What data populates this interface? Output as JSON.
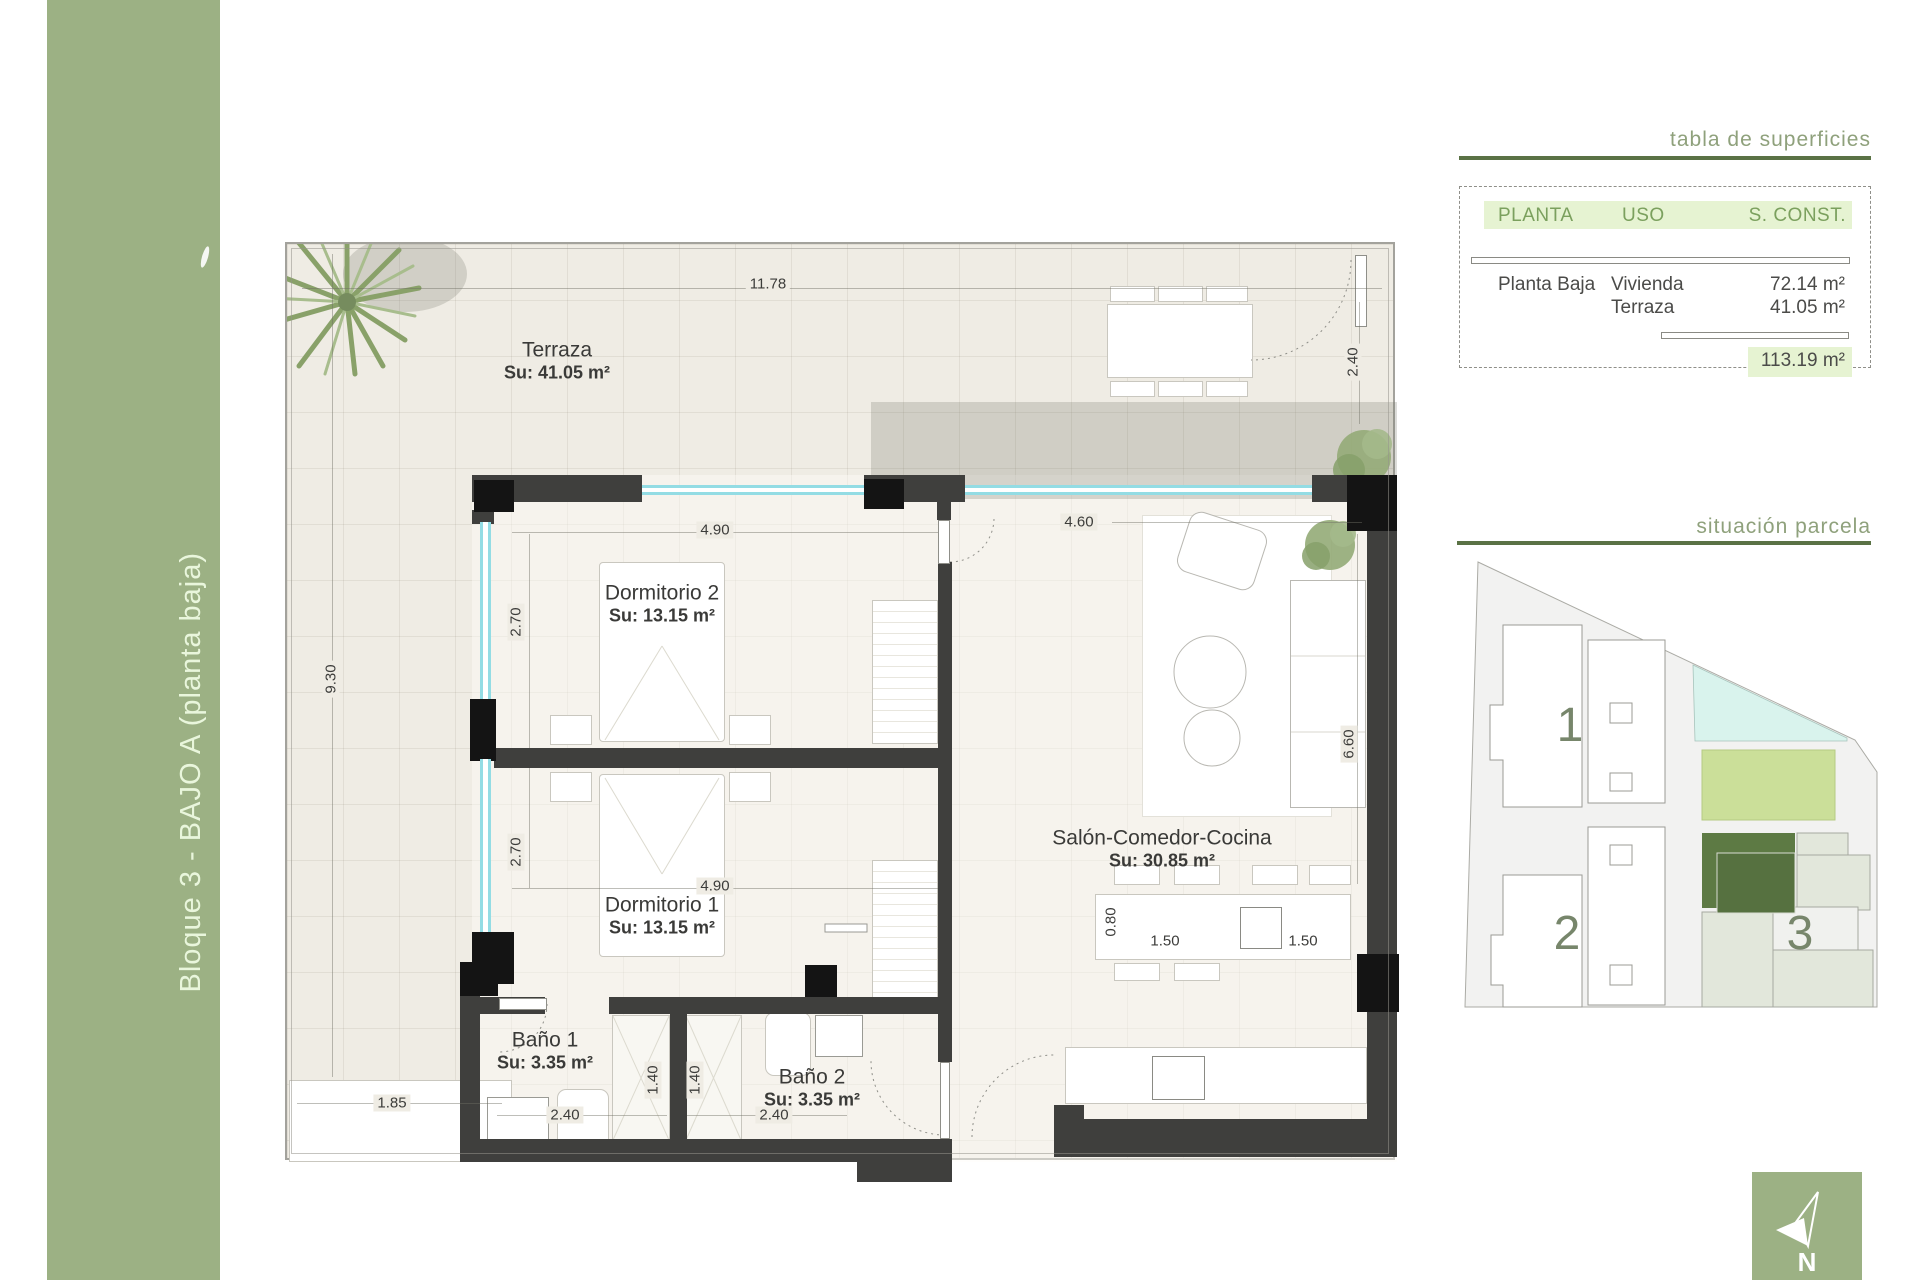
{
  "sidebar": {
    "label": "Bloque 3 - BAJO A (planta baja)"
  },
  "surfaces": {
    "title": "tabla de superficies",
    "headers": [
      "PLANTA",
      "USO",
      "S. CONST."
    ],
    "rows": [
      {
        "planta": "Planta Baja",
        "uso": "Vivienda",
        "sconst": "72.14 m²"
      },
      {
        "planta": "",
        "uso": "Terraza",
        "sconst": "41.05 m²"
      }
    ],
    "total": "113.19 m²"
  },
  "site": {
    "title": "situación parcela",
    "block1": "1",
    "block2": "2",
    "block3": "3"
  },
  "north": {
    "label": "N"
  },
  "plan": {
    "rooms": {
      "terraza": {
        "name": "Terraza",
        "area": "Su: 41.05 m²"
      },
      "dormitorio2": {
        "name": "Dormitorio 2",
        "area": "Su: 13.15 m²"
      },
      "dormitorio1": {
        "name": "Dormitorio 1",
        "area": "Su: 13.15 m²"
      },
      "salon": {
        "name": "Salón-Comedor-Cocina",
        "area": "Su: 30.85 m²"
      },
      "bano1": {
        "name": "Baño 1",
        "area": "Su: 3.35 m²"
      },
      "bano2": {
        "name": "Baño 2",
        "area": "Su: 3.35 m²"
      }
    },
    "dims": {
      "total_width": "11.78",
      "terrace_left_height": "9.30",
      "terrace_right_depth": "2.40",
      "dorm2_width": "4.90",
      "dorm2_height": "2.70",
      "dorm1_width": "4.90",
      "dorm1_height": "2.70",
      "salon_width": "4.60",
      "salon_height": "6.60",
      "planter_width": "1.85",
      "bano1_shower": "1.40",
      "bano2_shower": "1.40",
      "bano1_width": "2.40",
      "bano2_width": "2.40",
      "island_depth": "0.80",
      "island_left": "1.50",
      "island_right": "1.50"
    }
  },
  "colors": {
    "sidebar-green": "#9cb184",
    "accent-rule": "#5a7245",
    "panel-title": "#8fa17c",
    "table-green": "#7ba05e",
    "table-highlight": "#e6f3d2",
    "wall": "#3f3f3d",
    "glazing": "#93dce4",
    "site-pool": "#d9f3ed",
    "site-garden": "#cbdf99",
    "site-unit": "#5d7a44"
  }
}
